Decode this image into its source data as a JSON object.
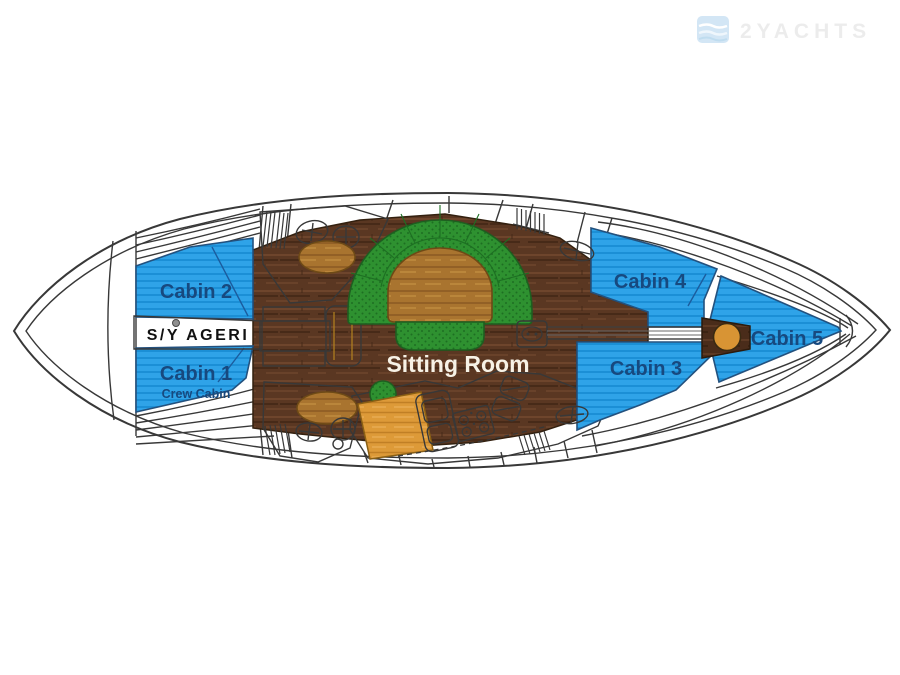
{
  "watermark": {
    "brand": "2YACHTS"
  },
  "plan": {
    "boat_name": "S/Y AGERI",
    "rooms": {
      "cabin1": "Cabin 1",
      "cabin1_sub": "Crew Cabin",
      "cabin2": "Cabin 2",
      "cabin3": "Cabin 3",
      "cabin4": "Cabin 4",
      "cabin5": "Cabin 5",
      "sitting_room": "Sitting Room"
    }
  },
  "colors": {
    "cabin_blue": "#2fa3e8",
    "cabin_blue_stripe": "#1b8fd6",
    "label_navy": "#17497f",
    "floor_wood_dark": "#5a3722",
    "floor_wood_streak": "#472a18",
    "table_wood_light": "#a9742f",
    "companionway_orange": "#dd9a38",
    "sofa_green": "#2e9130",
    "sofa_green_dot": "#1d6f22",
    "hull_outline": "#383838",
    "watermark_blue": "#cfe4f4",
    "watermark_text": "#ebebeb"
  }
}
